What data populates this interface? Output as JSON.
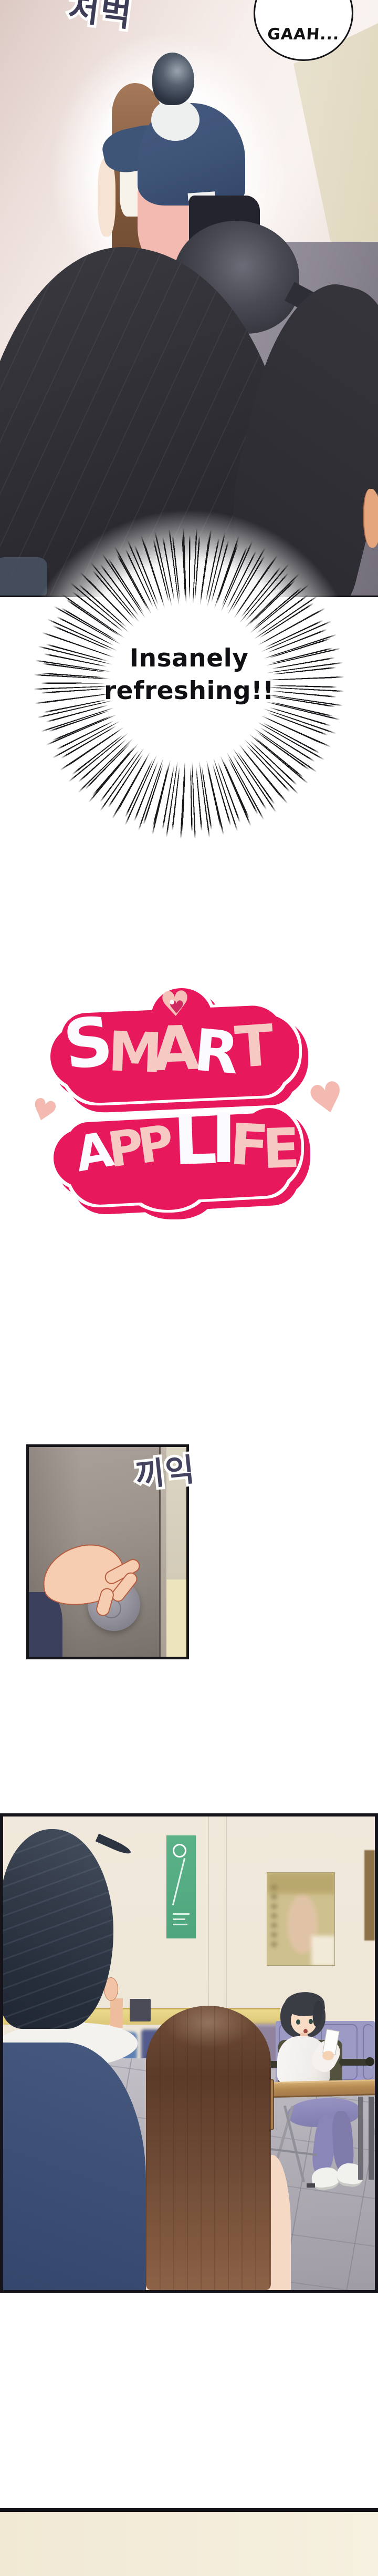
{
  "panel_hallway": {
    "sfx_footsteps": "처벅",
    "speech_bubble_text": "GAAH..."
  },
  "burst": {
    "line1": "Insanely",
    "line2": "refreshing!!"
  },
  "title_logo": {
    "full_title": "SMART APP LIFE",
    "smart_letters": [
      {
        "ch": "S"
      },
      {
        "ch": "M"
      },
      {
        "ch": "A"
      },
      {
        "ch": "R"
      },
      {
        "ch": "T"
      }
    ],
    "app_letters": [
      {
        "ch": "A"
      },
      {
        "ch": "P"
      },
      {
        "ch": "P"
      }
    ],
    "life_letters": [
      {
        "ch": "L"
      },
      {
        "ch": "I"
      },
      {
        "ch": "F"
      },
      {
        "ch": "E"
      }
    ],
    "heart_glyph": "♥"
  },
  "panel_door": {
    "sfx_creak": "끼익"
  },
  "colors": {
    "logo_pink": "#e7195c",
    "logo_letter_pink": "#f7c9c3",
    "logo_letter_white": "#fbfbff",
    "deco_heart_pink": "#f4b9b0",
    "sfx_ink_navy": "#3d3d58",
    "burst_ink": "#101014",
    "panel_border": "#14141a",
    "hall_floor_grey": "#8d8893",
    "classroom_wall": "#efe8da",
    "wainscot_yellow": "#e5d284",
    "seat_lavender": "#9b9ac4",
    "footer_cream": "#f3ecd9"
  }
}
